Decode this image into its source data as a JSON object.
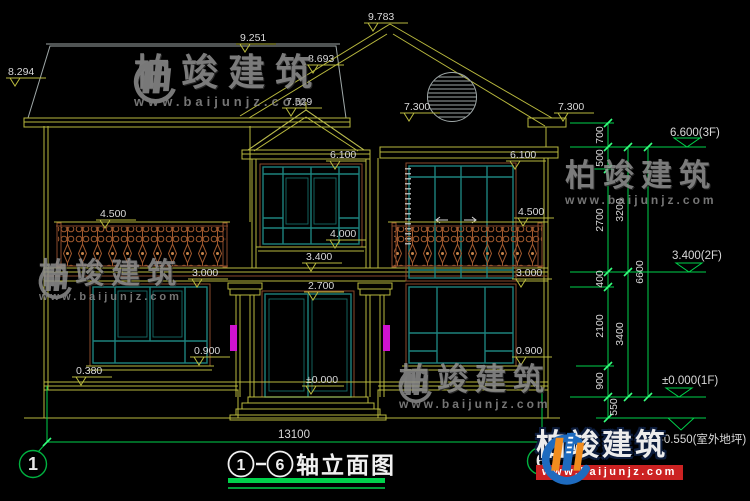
{
  "title": {
    "axis_start": "1",
    "dash": "-",
    "axis_end": "6",
    "name": "轴立面图"
  },
  "axes": {
    "left_bubble": "1",
    "right_bubble": "6"
  },
  "dimensions": {
    "overall_width": "13100",
    "facade": {
      "peak": "9.783",
      "ridge_left": "9.251",
      "ridge_mid": "8.693",
      "eave_far_left": "8.294",
      "bay_roof_peak": "7.529",
      "eave_center": "7.300",
      "eave_right": "7.300",
      "window2f_top_center": "6.100",
      "window2f_top_right": "6.100",
      "railing_left": "4.500",
      "railing_right": "4.500",
      "bay_window_sill": "4.000",
      "floor2_level": "3.400",
      "balcony_left": "3.000",
      "balcony_right": "3.000",
      "door_top": "2.700",
      "window1f_sill_left": "0.900",
      "window1f_sill_right": "0.900",
      "plinth_top": "0.380",
      "floor1_level": "±0.000"
    },
    "chain_inner": [
      "700",
      "500",
      "2700",
      "400",
      "2100",
      "900",
      "550"
    ],
    "chain_mid": [
      "3200",
      "3400"
    ],
    "chain_outer": [
      "6600"
    ]
  },
  "elevation_markers": {
    "f3": "6.600(3F)",
    "f2": "3.400(2F)",
    "f1": "±0.000(1F)",
    "ground": "-0.550(室外地坪)"
  },
  "watermark": {
    "brand": "柏竣建筑",
    "url": "www.baijunjz.com"
  },
  "logo": {
    "brand": "柏竣建筑",
    "url": "www.baijunjz.com"
  },
  "colors": {
    "background": "#000000",
    "line_yellow": "#b9b93e",
    "line_green": "#00d24b",
    "line_teal": "#1d827e",
    "line_brown": "#8a4a2b",
    "tile_gray": "#9fa8a8",
    "text_gray": "#d9d9d9",
    "lamp_magenta": "#d012d0",
    "logo_blue": "#1e6bbf",
    "logo_orange": "#f08c1e",
    "logo_red": "#cc2222"
  }
}
